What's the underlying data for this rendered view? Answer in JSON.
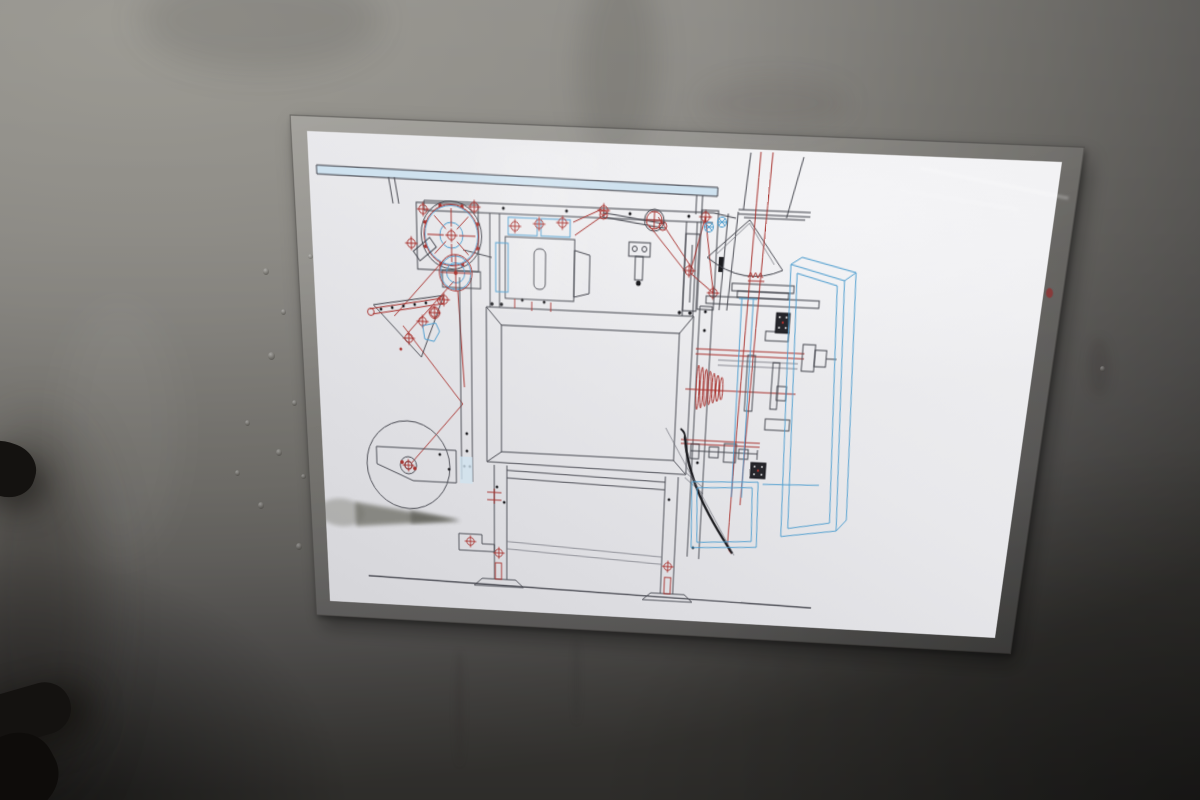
{
  "scene": {
    "type": "photograph",
    "subject": "Laminated CAD assembly drawing of a vertical packaging machine, in a clear plastic sleeve on a gray metal machine panel",
    "environment": "gray sheet-metal wall, lighter at top-left and falling into deep shadow at lower-right, water droplets left of the sheet, black grab-handle ends entering at the left edge"
  },
  "palette": {
    "wall_light": "#98968f",
    "wall_mid": "#7b7974",
    "wall_dark": "#4c4a46",
    "paper_bright": "#f0f0f2",
    "paper_base": "#e8e8eb",
    "paper_dim": "#d5d5d9",
    "line_dark": "#45464e",
    "line_red": "#a8322e",
    "line_blue": "#4f9ecf",
    "fill_light_blue": "#cfe2ef",
    "ink_black": "#1b1b1f",
    "handle_black": "#141210",
    "sleeve_edge": "rgba(45,43,40,0.45)"
  },
  "drawing": {
    "kind": "2D engineering assembly drawing, side elevation, no text or title block visible",
    "machine": "vertical form-fill-seal bagging machine",
    "components": [
      {
        "id": "top-rail",
        "label": "overhead mounting rail, light blue fill"
      },
      {
        "id": "film-spoked-wheel",
        "label": "red spoked film-feed wheel with belt lines"
      },
      {
        "id": "tension-wheel",
        "label": "lower blue tension pulley with red cross"
      },
      {
        "id": "dancer-arm",
        "label": "triangular dancer tension arm with red rollers"
      },
      {
        "id": "film-reel",
        "label": "film unwind reel, bracket and support column"
      },
      {
        "id": "seal-drive-box",
        "label": "sealing drive box with blue hatched rollers"
      },
      {
        "id": "linkage",
        "label": "crank linkage, red pulley and slotted plate"
      },
      {
        "id": "hopper",
        "label": "in-feed funnel, flange and forming collar with red spring"
      },
      {
        "id": "film-path",
        "label": "red film path lines running vertically"
      },
      {
        "id": "cabinet",
        "label": "main machine cabinet with beveled panel"
      },
      {
        "id": "under-frame",
        "label": "lower frame, stretchers and adjustable feet"
      },
      {
        "id": "back-unit",
        "label": "rear drive unit with shafts, red spring cone and bearings"
      },
      {
        "id": "discharge-chute",
        "label": "black curved discharge chute"
      },
      {
        "id": "blue-frames",
        "label": "blue wireframe guard frames"
      },
      {
        "id": "ground-line",
        "label": "floor reference line"
      }
    ]
  },
  "artifacts": {
    "sleeve": "clear plastic sleeve with visible dark edge around sheet",
    "smudge": "gray wedge-shaped shadow on lower-left of sheet",
    "droplets": "water droplets on the wall left of the sheet",
    "red_mark": "small red mark on the right sleeve edge",
    "handle": "two black rubber handle ends entering the frame at left"
  }
}
